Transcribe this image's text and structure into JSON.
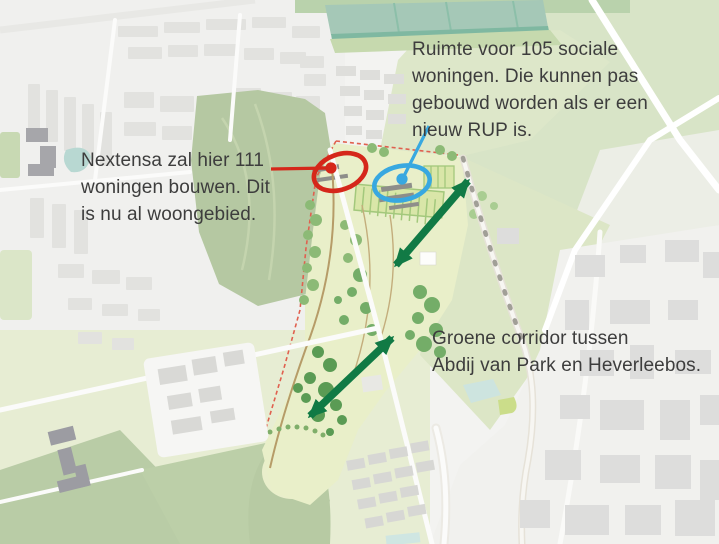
{
  "figure": {
    "type": "annotated-map",
    "callouts": [
      {
        "id": "nextensa",
        "text": "Nextensa zal hier 111\nwoningen bouwen. Dit\nis nu al woongebied.",
        "marker": "red-ellipse-with-leader-line",
        "color": "#d5271a"
      },
      {
        "id": "rup",
        "text": "Ruimte voor 105 sociale\nwoningen. Die kunnen pas\ngebouwd worden als er een\nnieuw RUP is.",
        "marker": "blue-ellipse-with-leader-line",
        "color": "#38a8e0"
      },
      {
        "id": "corridor",
        "text": "Groene corridor tussen\nAbdij van Park en Heverleebos.",
        "marker": "green-double-headed-arrows",
        "color": "#117a45"
      }
    ]
  },
  "colors": {
    "annot-red": "#d5271a",
    "annot-blue": "#38a8e0",
    "annot-green": "#117a45",
    "note-text": "#3d3d3d"
  }
}
